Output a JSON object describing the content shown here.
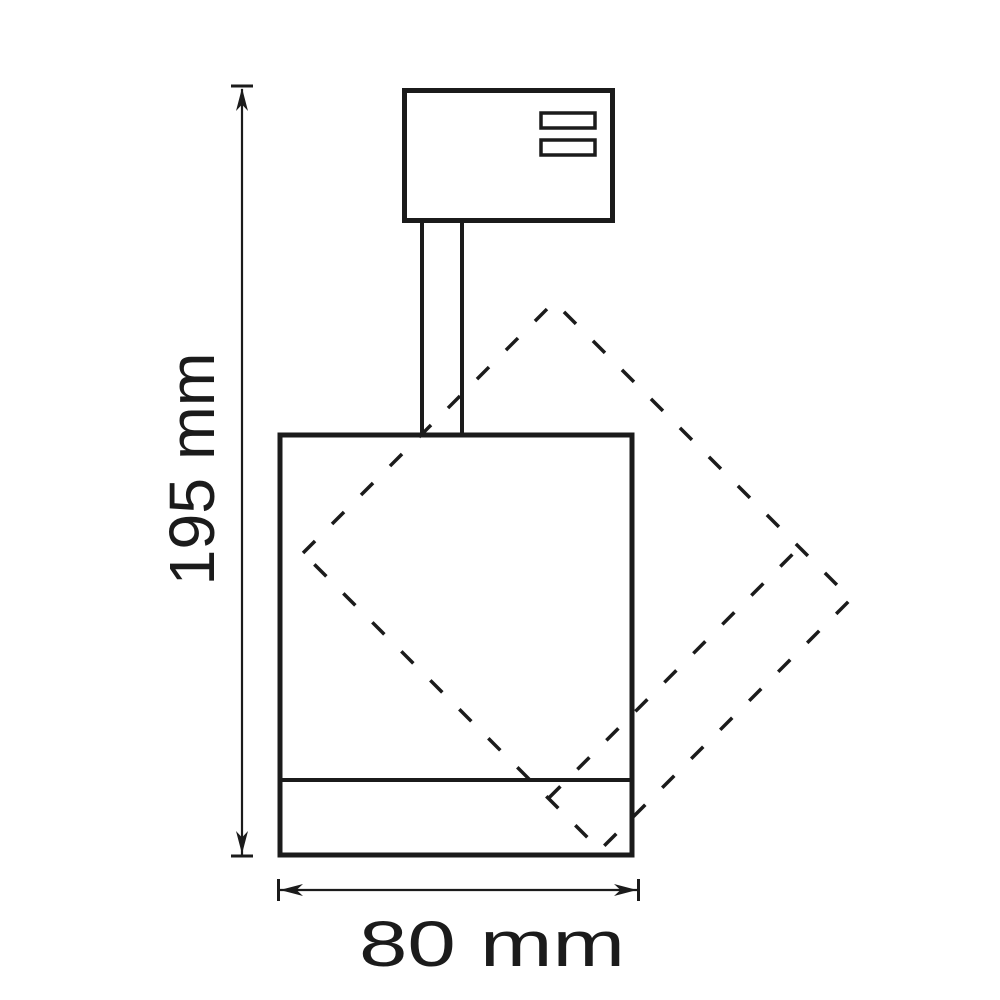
{
  "diagram": {
    "height_dimension_label": "195 mm",
    "width_dimension_label": "80 mm",
    "line_color": "#1b1b1b",
    "background_color": "#ffffff"
  }
}
